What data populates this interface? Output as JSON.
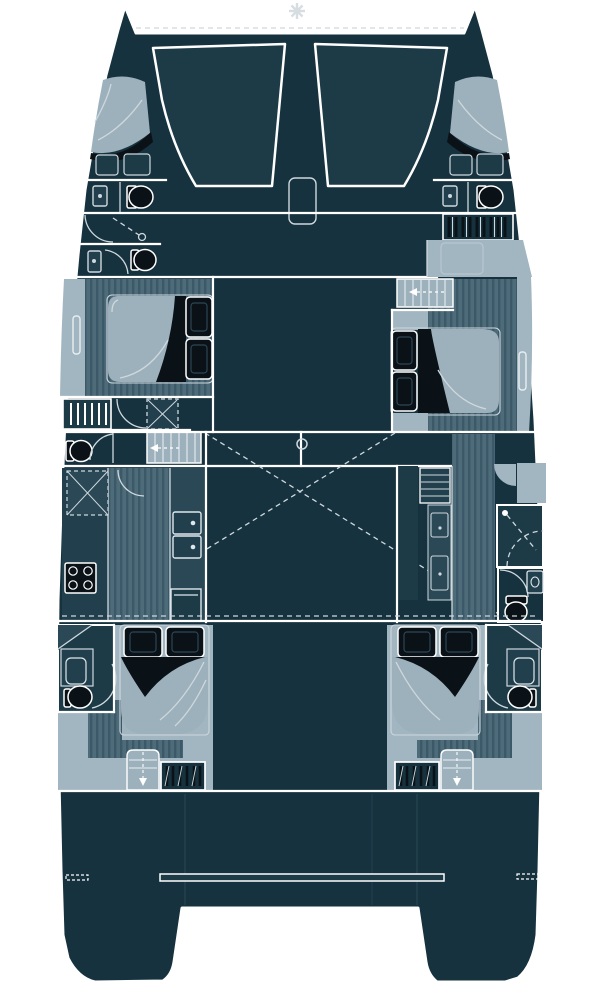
{
  "diagram": {
    "kind": "catamaran-floor-plan",
    "orientation": "bow-up",
    "hulls": 2,
    "cabins_with_double_beds": 6,
    "toilets_visible": 7,
    "showers_visible": 3,
    "features": {
      "bow": [
        "windlass",
        "trampoline-port",
        "trampoline-starboard",
        "anchor-locker-hatch",
        "bow-cabin-port",
        "bow-cabin-starboard"
      ],
      "midship": [
        "side-deck-port",
        "side-deck-starboard",
        "mid-cabin-port",
        "mid-cabin-starboard",
        "hanging-locker",
        "shower-pan",
        "head-toilet",
        "companionway-stairs",
        "mast-post"
      ],
      "saloon": [
        "galley-stove",
        "galley-double-sink",
        "galley-oven",
        "storage-x-cabinet",
        "shelf-unit",
        "cabinet-doors",
        "shower-room",
        "day-head",
        "corridor"
      ],
      "aft": [
        "aft-cabin-port",
        "aft-cabin-starboard",
        "aft-bathroom-port",
        "aft-bathroom-starboard",
        "stairs-down-port",
        "stairs-down-starboard",
        "hanging-locker-port",
        "hanging-locker-starboard"
      ],
      "stern": [
        "cockpit",
        "aft-bench-bar",
        "transom-port",
        "transom-starboard"
      ]
    }
  },
  "palette": {
    "page_background": "#ffffff",
    "hull_dark": "#16323e",
    "hull_dark_alt": "#1d3a47",
    "panel_teal": "#2a4856",
    "counter_teal": "#223f4d",
    "deck_light": "#a2b6c1",
    "deck_light_soft": "#9db1bd",
    "floor_wood": "#4e6b7a",
    "floor_wood_stripe": "#3c5969",
    "detail_black": "#0a1117",
    "line_white": "#ffffff",
    "line_soft": "#cfd8dd",
    "hatch_gray": "#d7dde0"
  }
}
